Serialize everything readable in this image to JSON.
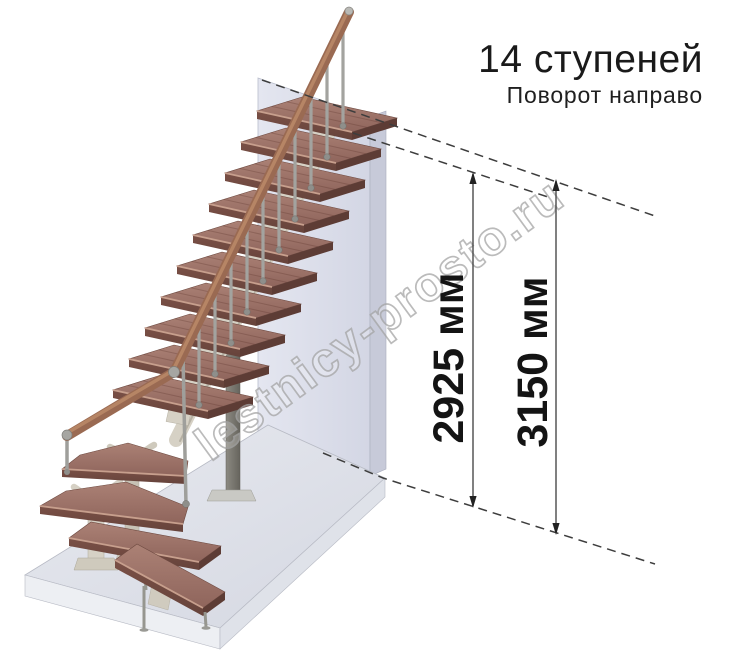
{
  "header": {
    "title": "14 ступеней",
    "subtitle": "Поворот направо"
  },
  "dimensions": {
    "flight_height": {
      "label": "2925 мм"
    },
    "total_height": {
      "label": "3150 мм"
    }
  },
  "watermark": {
    "text": "lestnicy-prosto.ru"
  },
  "colors": {
    "background": "#ffffff",
    "text": "#1a1a1a",
    "dimension_line": "#3d3d3d",
    "wood_top_light": "#ab8175",
    "wood_top_dark": "#8f655c",
    "wood_front_light": "#7a5046",
    "wood_front_dark": "#66433b",
    "wood_end": "#5d3c35",
    "wood_nose": "#c79f8d",
    "handrail": "#9a6a52",
    "handrail_highlight": "#bb8a68",
    "metal": "#a3a39f",
    "metal_dark": "#6e6e6a",
    "support_cream": "#d6d1c5",
    "support_cream_shadow": "#c7c2b5",
    "post_dark": "#75736c",
    "wall_light": "#e4e6f0",
    "wall_dark": "#d3d6e4",
    "wall_side": "#c7cad9",
    "floor_light": "#e8eaf0",
    "floor_dark": "#d4d7e1",
    "watermark_stroke": "#a5a5a5"
  }
}
